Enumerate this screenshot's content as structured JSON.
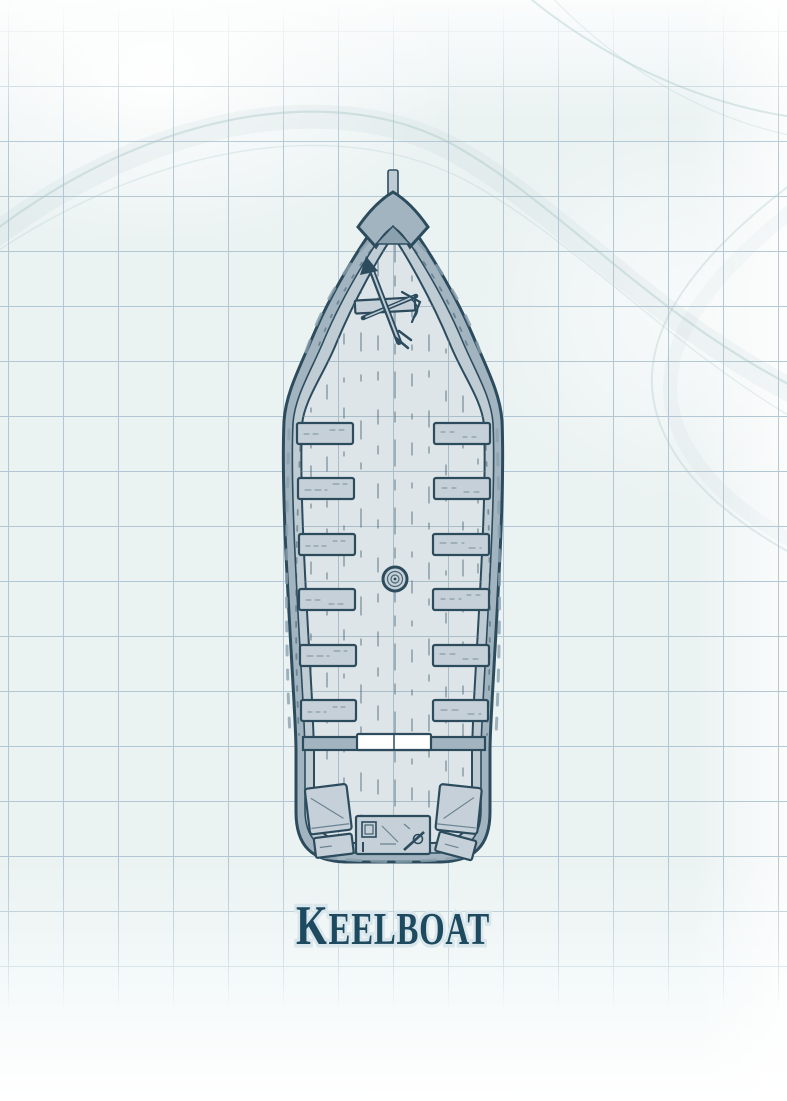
{
  "title": {
    "initial": "K",
    "rest": "EELBOAT",
    "full": "KEELBOAT"
  },
  "map": {
    "type": "battle-map",
    "subject": "Keelboat deck plan, top-down view on blueprint grid",
    "grid": {
      "cell_size_px": 55
    },
    "features": [
      {
        "name": "bowsprit"
      },
      {
        "name": "prow-cap"
      },
      {
        "name": "anchor-windlass"
      },
      {
        "name": "rowing-bench",
        "count": 12
      },
      {
        "name": "rope-coil"
      },
      {
        "name": "stern-bulkhead"
      },
      {
        "name": "gangplank"
      },
      {
        "name": "stern-crate",
        "count": 2
      },
      {
        "name": "toolbox"
      }
    ]
  },
  "colors": {
    "background": "#ebf2f2",
    "background_top": "#fbfdfd",
    "background_bottom": "#ffffff",
    "grid_line": "#a9c0ce",
    "deck_grid": "#7f9fb0",
    "outline": "#2c4c5e",
    "hull_fill": "#a2b4bf",
    "hull_shade": "#8ba1af",
    "gunwale_fill": "#c0ccd4",
    "deck_fill": "#dee5e9",
    "bench_fill": "#c6d0d8",
    "plank_mark": "#3a5a6d",
    "white": "#ffffff",
    "title_ink": "#1d4a5e",
    "title_halo": "#d9e6ec",
    "wisp": "#9dbfc1"
  }
}
